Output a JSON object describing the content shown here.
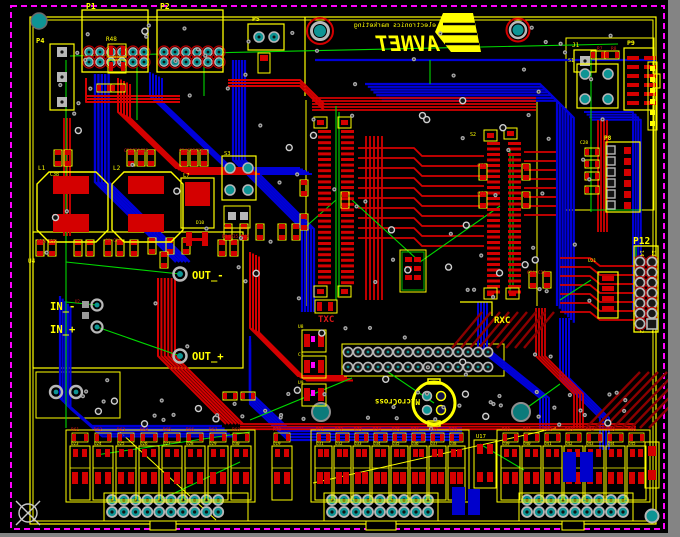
{
  "canvas": {
    "width": 680,
    "height": 537
  },
  "colors": {
    "pasteboard": "#848484",
    "board": "#000000",
    "top_copper": "#d40000",
    "bottom_copper": "#0000d8",
    "silkscreen": "#ffff00",
    "ratsnest": "#00d800",
    "keepout": "#ff00ff",
    "pad_teal": "#0e9494",
    "via_gray": "#a8a8a8",
    "polygon_maroon": "#8a0000"
  },
  "logo": {
    "line1": "electronics marketing",
    "line2": "AVNET"
  },
  "logo2": {
    "text": "MicroCross"
  },
  "named_labels": {
    "p1": "P1",
    "p2": "P2",
    "p4": "P4",
    "p5": "P5",
    "r48": "R48",
    "j1": "J1",
    "p9": "P9",
    "p8": "P8",
    "p12": "P12",
    "pin14": "14",
    "pin13": "13",
    "pin2": "2",
    "pin1": "1",
    "txc": "TXC",
    "rxc": "RXC",
    "out_minus": "OUT_-",
    "out_plus": "OUT_+",
    "in_minus": "IN_-",
    "in_plus": "IN_+",
    "u4": "U4",
    "l1": "L1",
    "l2": "L2",
    "u17": "U17"
  },
  "tiny_labels": [
    {
      "t": "C32C33C35",
      "x": 124,
      "y": 152,
      "c": "#e01818",
      "s": 4.5
    },
    {
      "t": "C34C35C36",
      "x": 179,
      "y": 152,
      "c": "#e01818",
      "s": 4.5
    },
    {
      "t": "C38",
      "x": 50,
      "y": 176,
      "c": "#ffff00",
      "s": 5
    },
    {
      "t": "L7",
      "x": 183,
      "y": 177,
      "c": "#ffff00",
      "s": 5.5
    },
    {
      "t": "S3",
      "x": 224,
      "y": 155,
      "c": "#ffff00",
      "s": 5.5
    },
    {
      "t": "R50 R52",
      "x": 38,
      "y": 243,
      "c": "#e01818",
      "s": 4.5
    },
    {
      "t": "C8 C21",
      "x": 105,
      "y": 242,
      "c": "#e01818",
      "s": 4.5
    },
    {
      "t": "R34R35 R42",
      "x": 222,
      "y": 238,
      "c": "#e01818",
      "s": 4.5
    },
    {
      "t": "D10",
      "x": 196,
      "y": 224,
      "c": "#ffff00",
      "s": 4.5
    },
    {
      "t": "U2",
      "x": 75,
      "y": 303,
      "c": "#e01818",
      "s": 4
    },
    {
      "t": "S2",
      "x": 470,
      "y": 136,
      "c": "#ffff00",
      "s": 5
    },
    {
      "t": "S1",
      "x": 568,
      "y": 62,
      "c": "#ffff00",
      "s": 5
    },
    {
      "t": "R7",
      "x": 597,
      "y": 50,
      "c": "#e01818",
      "s": 4.5
    },
    {
      "t": "R8",
      "x": 611,
      "y": 50,
      "c": "#e01818",
      "s": 4.5
    },
    {
      "t": "C28",
      "x": 580,
      "y": 144,
      "c": "#ffff00",
      "s": 4.5
    },
    {
      "t": "U21",
      "x": 588,
      "y": 262,
      "c": "#ffff00",
      "s": 4.5
    },
    {
      "t": "U8",
      "x": 298,
      "y": 328,
      "c": "#ffff00",
      "s": 4.5
    },
    {
      "t": "C9",
      "x": 298,
      "y": 356,
      "c": "#ffff00",
      "s": 4.5
    },
    {
      "t": "U9",
      "x": 298,
      "y": 384,
      "c": "#ffff00",
      "s": 4.5
    },
    {
      "t": "C13",
      "x": 477,
      "y": 167,
      "c": "#e01818",
      "s": 4.5
    },
    {
      "t": "C16",
      "x": 477,
      "y": 195,
      "c": "#e01818",
      "s": 4.5
    },
    {
      "t": "C20 C19",
      "x": 527,
      "y": 274,
      "c": "#e01818",
      "s": 4.5
    }
  ],
  "relay_groups": [
    {
      "x0": 70,
      "step": 23,
      "w": 20,
      "count": 8,
      "r_labels": [
        "R61",
        "R62",
        "R63",
        "R64",
        "R65",
        "R66",
        "R67",
        "R68"
      ],
      "u_labels": [
        "U23",
        "U24",
        "U25",
        "U26",
        "U27",
        "U28",
        "U29",
        "U30"
      ]
    },
    {
      "x0": 272,
      "step": 23,
      "w": 20,
      "count": 1,
      "r_labels": [
        "R70"
      ],
      "u_labels": [
        "U19"
      ]
    },
    {
      "x0": 315,
      "step": 19,
      "w": 17,
      "count": 8,
      "r_labels": [
        "R71",
        "R72",
        "R73",
        "R74",
        "R75",
        "R76",
        "R77",
        "R78"
      ],
      "u_labels": [
        "U31",
        "U32",
        "U33",
        "U34",
        "U35",
        "U36",
        "U37",
        "U38"
      ]
    },
    {
      "x0": 501,
      "step": 21,
      "w": 19,
      "count": 7,
      "r_labels": [
        "R80",
        "R81",
        "R82",
        "R83",
        "R84",
        "R85",
        "R86"
      ],
      "u_labels": [
        "U39",
        "U40",
        "U41",
        "U42",
        "U43",
        "U44",
        "U45"
      ]
    }
  ]
}
